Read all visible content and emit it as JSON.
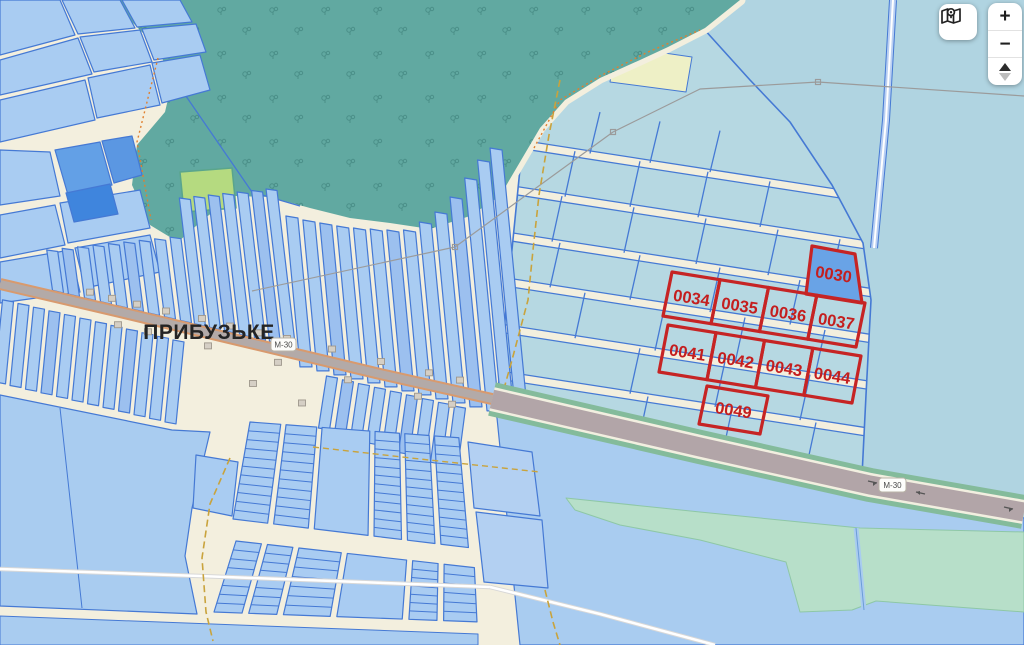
{
  "map": {
    "place_label": "ПРИБУЗЬКЕ",
    "road_shield": "М-30",
    "highlighted_parcels": [
      {
        "id": "0030"
      },
      {
        "id": "0034"
      },
      {
        "id": "0035"
      },
      {
        "id": "0036"
      },
      {
        "id": "0037"
      },
      {
        "id": "0041"
      },
      {
        "id": "0042"
      },
      {
        "id": "0043"
      },
      {
        "id": "0044"
      },
      {
        "id": "0049"
      }
    ]
  },
  "controls": {
    "zoom_in": "+",
    "zoom_out": "−",
    "layers_icon": "map-pin-icon",
    "pan_icons": "triangle-up-down"
  },
  "colors": {
    "base": "#b0d4e1",
    "cream": "#f3efde",
    "parcel": "#a9ccf2",
    "parcelDark": "#9cc0ef",
    "parcelStroke": "#4579d4",
    "periwinkle": "#a9ccf0",
    "forest": "#61a9a1",
    "tree": "#4a8f88",
    "greenParcel": "#b5da80",
    "paleYellow": "#eef0c6",
    "midBlue": "#63a0e6",
    "deepBlue": "#3f85dd",
    "p0030": "#69a3e6",
    "red": "#c62424",
    "redText": "#c41e1e",
    "mint": "#b7dfc9",
    "mintStroke": "#8ec7a6",
    "asphalt": "#b2a5a8",
    "verge": "#84bb9b",
    "roadEdge": "#f2efe0",
    "street": "#b3aaa8",
    "streetEdge": "#d89a6e",
    "building": "#d5cfc5",
    "buildingStroke": "#9e978c",
    "powerline": "#9b9b9b",
    "dashPath": "#c9a33c",
    "canal": "#b9cff2",
    "white": "#ffffff"
  }
}
